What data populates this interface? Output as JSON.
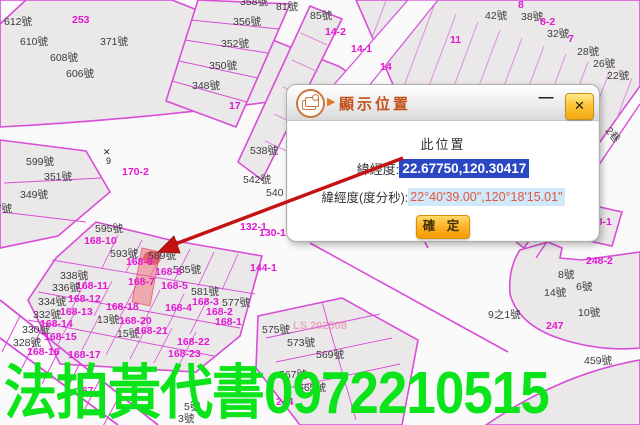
{
  "dialog": {
    "title": "顯示位置",
    "heading": "此位置",
    "row1_label": "緯經度:",
    "row1_value": "22.67750,120.30417",
    "row2_label": "緯經度(度分秒):",
    "row2_value": "22°40'39.00\",120°18'15.01\"",
    "confirm_label": "確 定",
    "minimize_glyph": "—",
    "close_glyph": "✕",
    "selection_color": "#2b47c3",
    "dms_highlight_color": "#cfe9fb",
    "dms_text_color": "#e2573d",
    "title_color": "#c2511a"
  },
  "watermark": {
    "text": "法拍黃代書0972210515",
    "color": "#0be41a"
  },
  "map": {
    "line_color": "#d84ed8",
    "label_color_black": "#3c3c3c",
    "label_color_magenta": "#e318d4",
    "highlight_color": "rgba(242,106,116,0.5)",
    "arrow_color": "#c41111",
    "labels": [
      {
        "t": "612號",
        "x": 4,
        "y": 17,
        "c": "b"
      },
      {
        "t": "610號",
        "x": 20,
        "y": 37,
        "c": "b"
      },
      {
        "t": "608號",
        "x": 50,
        "y": 53,
        "c": "b"
      },
      {
        "t": "606號",
        "x": 66,
        "y": 69,
        "c": "b"
      },
      {
        "t": "371號",
        "x": 100,
        "y": 37,
        "c": "b"
      },
      {
        "t": "253",
        "x": 72,
        "y": 15,
        "c": "m"
      },
      {
        "t": "358號",
        "x": 240,
        "y": -3,
        "c": "b"
      },
      {
        "t": "81號",
        "x": 276,
        "y": 2,
        "c": "b"
      },
      {
        "t": "356號",
        "x": 233,
        "y": 17,
        "c": "b"
      },
      {
        "t": "352號",
        "x": 221,
        "y": 39,
        "c": "b"
      },
      {
        "t": "350號",
        "x": 209,
        "y": 61,
        "c": "b"
      },
      {
        "t": "348號",
        "x": 192,
        "y": 81,
        "c": "b"
      },
      {
        "t": "17",
        "x": 229,
        "y": 101,
        "c": "m"
      },
      {
        "t": "85號",
        "x": 310,
        "y": 11,
        "c": "b"
      },
      {
        "t": "14-2",
        "x": 325,
        "y": 27,
        "c": "m"
      },
      {
        "t": "14-1",
        "x": 351,
        "y": 44,
        "c": "m"
      },
      {
        "t": "14",
        "x": 380,
        "y": 62,
        "c": "m"
      },
      {
        "t": "11",
        "x": 450,
        "y": 35,
        "c": "m"
      },
      {
        "t": "42號",
        "x": 485,
        "y": 11,
        "c": "b"
      },
      {
        "t": "8",
        "x": 518,
        "y": 0,
        "c": "m"
      },
      {
        "t": "38號",
        "x": 521,
        "y": 12,
        "c": "b"
      },
      {
        "t": "8-2",
        "x": 540,
        "y": 17,
        "c": "m"
      },
      {
        "t": "32號",
        "x": 547,
        "y": 29,
        "c": "b"
      },
      {
        "t": "7",
        "x": 568,
        "y": 34,
        "c": "m"
      },
      {
        "t": "28號",
        "x": 577,
        "y": 47,
        "c": "b"
      },
      {
        "t": "26號",
        "x": 593,
        "y": 59,
        "c": "b"
      },
      {
        "t": "22號",
        "x": 607,
        "y": 71,
        "c": "b"
      },
      {
        "t": "2巷",
        "x": 604,
        "y": 130,
        "c": "b",
        "r": 50
      },
      {
        "t": "538號",
        "x": 250,
        "y": 146,
        "c": "b"
      },
      {
        "t": "542號",
        "x": 243,
        "y": 175,
        "c": "b"
      },
      {
        "t": "540",
        "x": 266,
        "y": 188,
        "c": "b"
      },
      {
        "t": "170-2",
        "x": 122,
        "y": 167,
        "c": "m"
      },
      {
        "t": "✕",
        "x": 103,
        "y": 148,
        "c": "s"
      },
      {
        "t": "9",
        "x": 106,
        "y": 157,
        "c": "s"
      },
      {
        "t": "132-1",
        "x": 240,
        "y": 222,
        "c": "m"
      },
      {
        "t": "130-1",
        "x": 259,
        "y": 228,
        "c": "m"
      },
      {
        "t": "144-1",
        "x": 250,
        "y": 263,
        "c": "m"
      },
      {
        "t": "248-1",
        "x": 585,
        "y": 217,
        "c": "m"
      },
      {
        "t": "248-2",
        "x": 586,
        "y": 256,
        "c": "m"
      },
      {
        "t": "8號",
        "x": 558,
        "y": 270,
        "c": "b"
      },
      {
        "t": "6號",
        "x": 576,
        "y": 282,
        "c": "b"
      },
      {
        "t": "14號",
        "x": 544,
        "y": 288,
        "c": "b"
      },
      {
        "t": "10號",
        "x": 578,
        "y": 308,
        "c": "b"
      },
      {
        "t": "9之1號",
        "x": 488,
        "y": 310,
        "c": "b"
      },
      {
        "t": "247",
        "x": 546,
        "y": 321,
        "c": "m"
      },
      {
        "t": "599號",
        "x": 26,
        "y": 157,
        "c": "b"
      },
      {
        "t": "351號",
        "x": 44,
        "y": 172,
        "c": "b"
      },
      {
        "t": "349號",
        "x": 20,
        "y": 190,
        "c": "b"
      },
      {
        "t": "347號",
        "x": -16,
        "y": 204,
        "c": "b"
      },
      {
        "t": "595號",
        "x": 95,
        "y": 224,
        "c": "b"
      },
      {
        "t": "168-10",
        "x": 84,
        "y": 236,
        "c": "m"
      },
      {
        "t": "593號",
        "x": 110,
        "y": 249,
        "c": "b"
      },
      {
        "t": "589號",
        "x": 148,
        "y": 251,
        "c": "b"
      },
      {
        "t": "168-9",
        "x": 126,
        "y": 257,
        "c": "m"
      },
      {
        "t": "585號",
        "x": 173,
        "y": 265,
        "c": "b"
      },
      {
        "t": "168-8",
        "x": 155,
        "y": 267,
        "c": "m"
      },
      {
        "t": "168-7",
        "x": 128,
        "y": 277,
        "c": "m"
      },
      {
        "t": "168-5",
        "x": 161,
        "y": 281,
        "c": "m"
      },
      {
        "t": "581號",
        "x": 191,
        "y": 287,
        "c": "b"
      },
      {
        "t": "168-3",
        "x": 192,
        "y": 297,
        "c": "m"
      },
      {
        "t": "577號",
        "x": 222,
        "y": 298,
        "c": "b"
      },
      {
        "t": "168-4",
        "x": 165,
        "y": 303,
        "c": "m"
      },
      {
        "t": "168-2",
        "x": 206,
        "y": 307,
        "c": "m"
      },
      {
        "t": "168-1",
        "x": 215,
        "y": 317,
        "c": "m"
      },
      {
        "t": "338號",
        "x": 60,
        "y": 271,
        "c": "b"
      },
      {
        "t": "168-11",
        "x": 76,
        "y": 281,
        "c": "m"
      },
      {
        "t": "336號",
        "x": 52,
        "y": 283,
        "c": "b"
      },
      {
        "t": "168-12",
        "x": 68,
        "y": 294,
        "c": "m"
      },
      {
        "t": "334號",
        "x": 38,
        "y": 297,
        "c": "b"
      },
      {
        "t": "168-13",
        "x": 60,
        "y": 307,
        "c": "m"
      },
      {
        "t": "332號",
        "x": 33,
        "y": 310,
        "c": "b"
      },
      {
        "t": "168-18",
        "x": 106,
        "y": 302,
        "c": "m"
      },
      {
        "t": "330號",
        "x": 22,
        "y": 325,
        "c": "b"
      },
      {
        "t": "168-14",
        "x": 40,
        "y": 319,
        "c": "m"
      },
      {
        "t": "328號",
        "x": 13,
        "y": 338,
        "c": "b"
      },
      {
        "t": "168-15",
        "x": 44,
        "y": 332,
        "c": "m"
      },
      {
        "t": "13號",
        "x": 97,
        "y": 315,
        "c": "b"
      },
      {
        "t": "168-20",
        "x": 119,
        "y": 316,
        "c": "m"
      },
      {
        "t": "15號",
        "x": 117,
        "y": 329,
        "c": "b"
      },
      {
        "t": "168-21",
        "x": 135,
        "y": 326,
        "c": "m"
      },
      {
        "t": "168-16",
        "x": 27,
        "y": 347,
        "c": "m"
      },
      {
        "t": "168-17",
        "x": 68,
        "y": 350,
        "c": "m"
      },
      {
        "t": "168-22",
        "x": 177,
        "y": 337,
        "c": "m"
      },
      {
        "t": "168-23",
        "x": 168,
        "y": 349,
        "c": "m"
      },
      {
        "t": "LS 202508",
        "x": 293,
        "y": 321,
        "c": "f"
      },
      {
        "t": "575號",
        "x": 262,
        "y": 325,
        "c": "b"
      },
      {
        "t": "573號",
        "x": 287,
        "y": 338,
        "c": "b"
      },
      {
        "t": "569號",
        "x": 316,
        "y": 350,
        "c": "b"
      },
      {
        "t": "567號",
        "x": 279,
        "y": 370,
        "c": "b"
      },
      {
        "t": "565號",
        "x": 298,
        "y": 383,
        "c": "b"
      },
      {
        "t": "244",
        "x": 276,
        "y": 397,
        "c": "m"
      },
      {
        "t": "459號",
        "x": 584,
        "y": 356,
        "c": "b"
      },
      {
        "t": "167",
        "x": 76,
        "y": 386,
        "c": "m"
      },
      {
        "t": "5號",
        "x": 184,
        "y": 402,
        "c": "b"
      },
      {
        "t": "3號",
        "x": 178,
        "y": 414,
        "c": "b"
      }
    ]
  }
}
